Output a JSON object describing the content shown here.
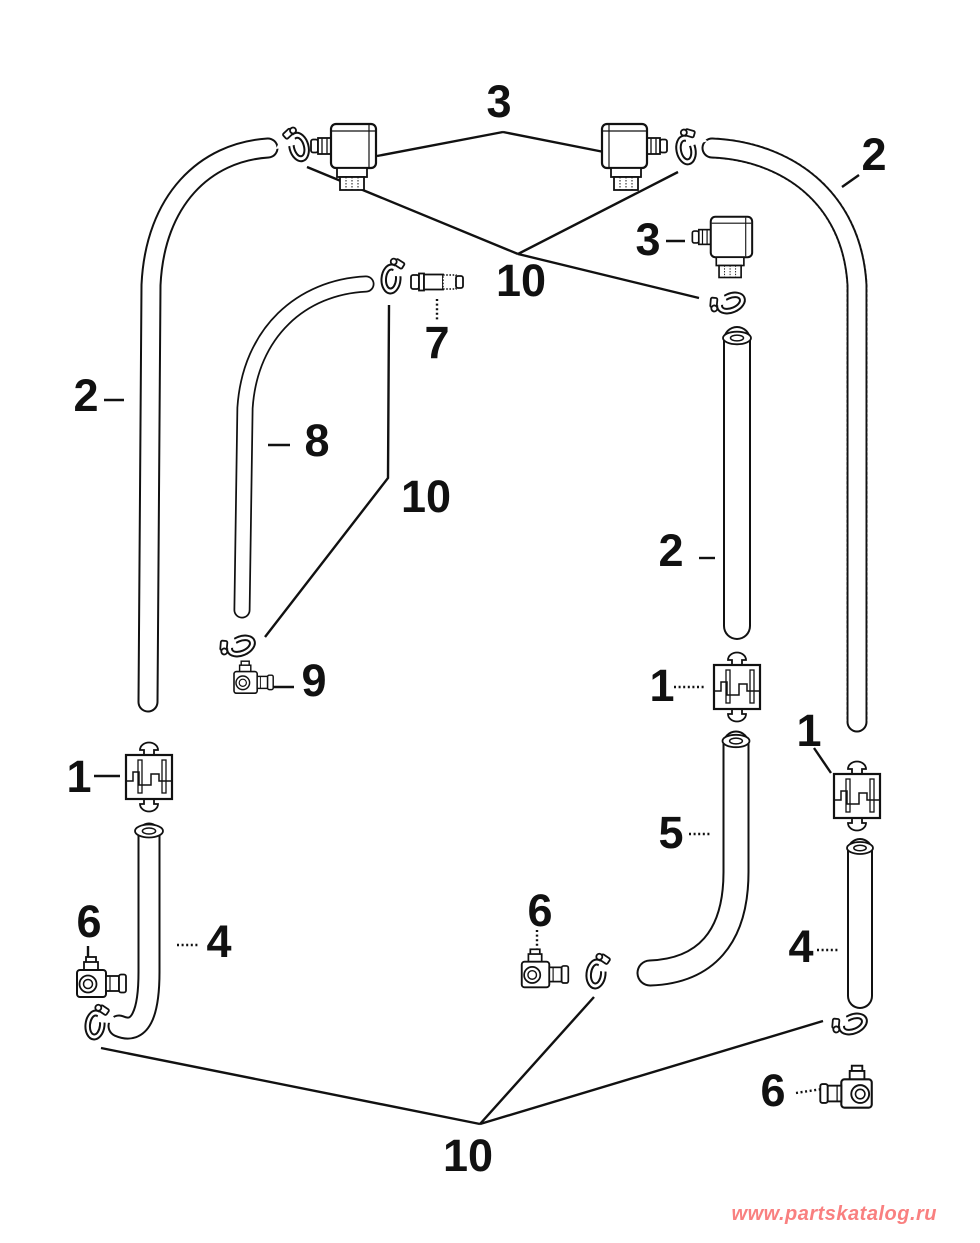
{
  "page": {
    "background_color": "#ffffff",
    "line_color": "#111111",
    "description": "Fuel hose and clamp exploded parts diagram"
  },
  "watermark": {
    "text": "www.partskatalog.ru",
    "color": "#f98080"
  },
  "part_numbers_shown": [
    "1",
    "2",
    "3",
    "4",
    "5",
    "6",
    "7",
    "8",
    "9",
    "10"
  ],
  "callouts": [
    {
      "id": "callout-3-top",
      "label": "3"
    },
    {
      "id": "callout-10-top",
      "label": "10"
    },
    {
      "id": "callout-2-right-top",
      "label": "2"
    },
    {
      "id": "callout-3-right",
      "label": "3"
    },
    {
      "id": "callout-7",
      "label": "7"
    },
    {
      "id": "callout-2-left",
      "label": "2"
    },
    {
      "id": "callout-8",
      "label": "8"
    },
    {
      "id": "callout-10-mid",
      "label": "10"
    },
    {
      "id": "callout-2-mid",
      "label": "2"
    },
    {
      "id": "callout-1-mid",
      "label": "1"
    },
    {
      "id": "callout-9",
      "label": "9"
    },
    {
      "id": "callout-1-right",
      "label": "1"
    },
    {
      "id": "callout-1-left",
      "label": "1"
    },
    {
      "id": "callout-5",
      "label": "5"
    },
    {
      "id": "callout-6-mid",
      "label": "6"
    },
    {
      "id": "callout-6-left",
      "label": "6"
    },
    {
      "id": "callout-4-left",
      "label": "4"
    },
    {
      "id": "callout-4-right",
      "label": "4"
    },
    {
      "id": "callout-6-right",
      "label": "6"
    },
    {
      "id": "callout-10-bottom",
      "label": "10"
    }
  ]
}
